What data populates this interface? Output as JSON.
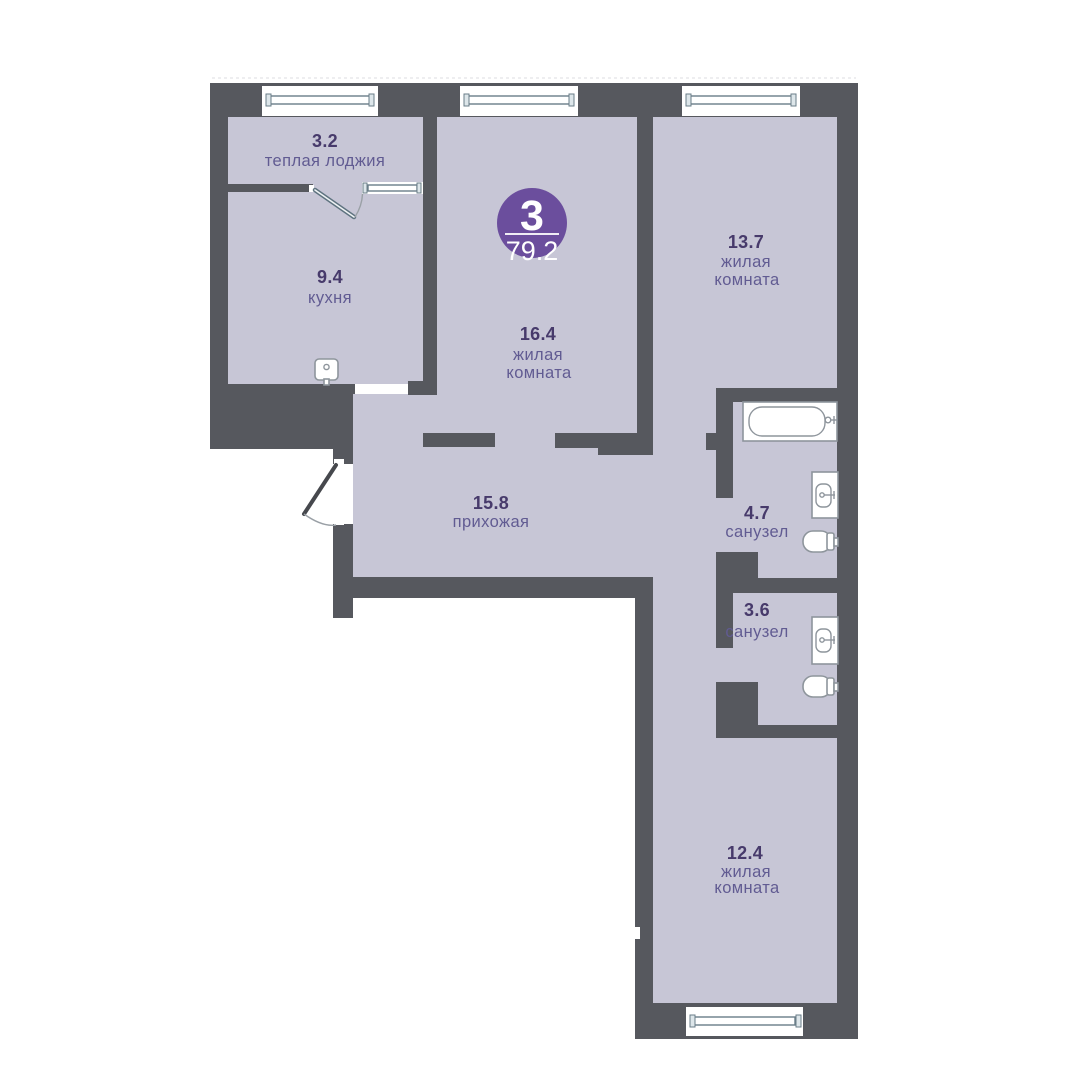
{
  "plan_title": "apartment floor plan",
  "badge": {
    "room_count": "3",
    "total_area": "79.2"
  },
  "rooms": {
    "loggia": {
      "area": "3.2",
      "name": "теплая лоджия"
    },
    "kitchen": {
      "area": "9.4",
      "name": "кухня"
    },
    "living_middle": {
      "area": "16.4",
      "name_line1": "жилая",
      "name_line2": "комната"
    },
    "living_right": {
      "area": "13.7",
      "name_line1": "жилая",
      "name_line2": "комната"
    },
    "hallway": {
      "area": "15.8",
      "name": "прихожая"
    },
    "bathroom_large": {
      "area": "4.7",
      "name": "санузел"
    },
    "bathroom_small": {
      "area": "3.6",
      "name": "санузел"
    },
    "living_bottom": {
      "area": "12.4",
      "name_line1": "жилая",
      "name_line2": "комната"
    }
  },
  "colors": {
    "wall": "#56585e",
    "floor": "#c7c6d6",
    "badge": "#6b4e9d",
    "area_number": "#473a6b",
    "room_label": "#615b92",
    "window_glazing": "#6a7d88",
    "fixture_outline": "#8e959c"
  },
  "fixtures": [
    "bathtub",
    "sink",
    "toilet",
    "sink",
    "toilet",
    "kitchen-sink"
  ],
  "window_count": "5"
}
